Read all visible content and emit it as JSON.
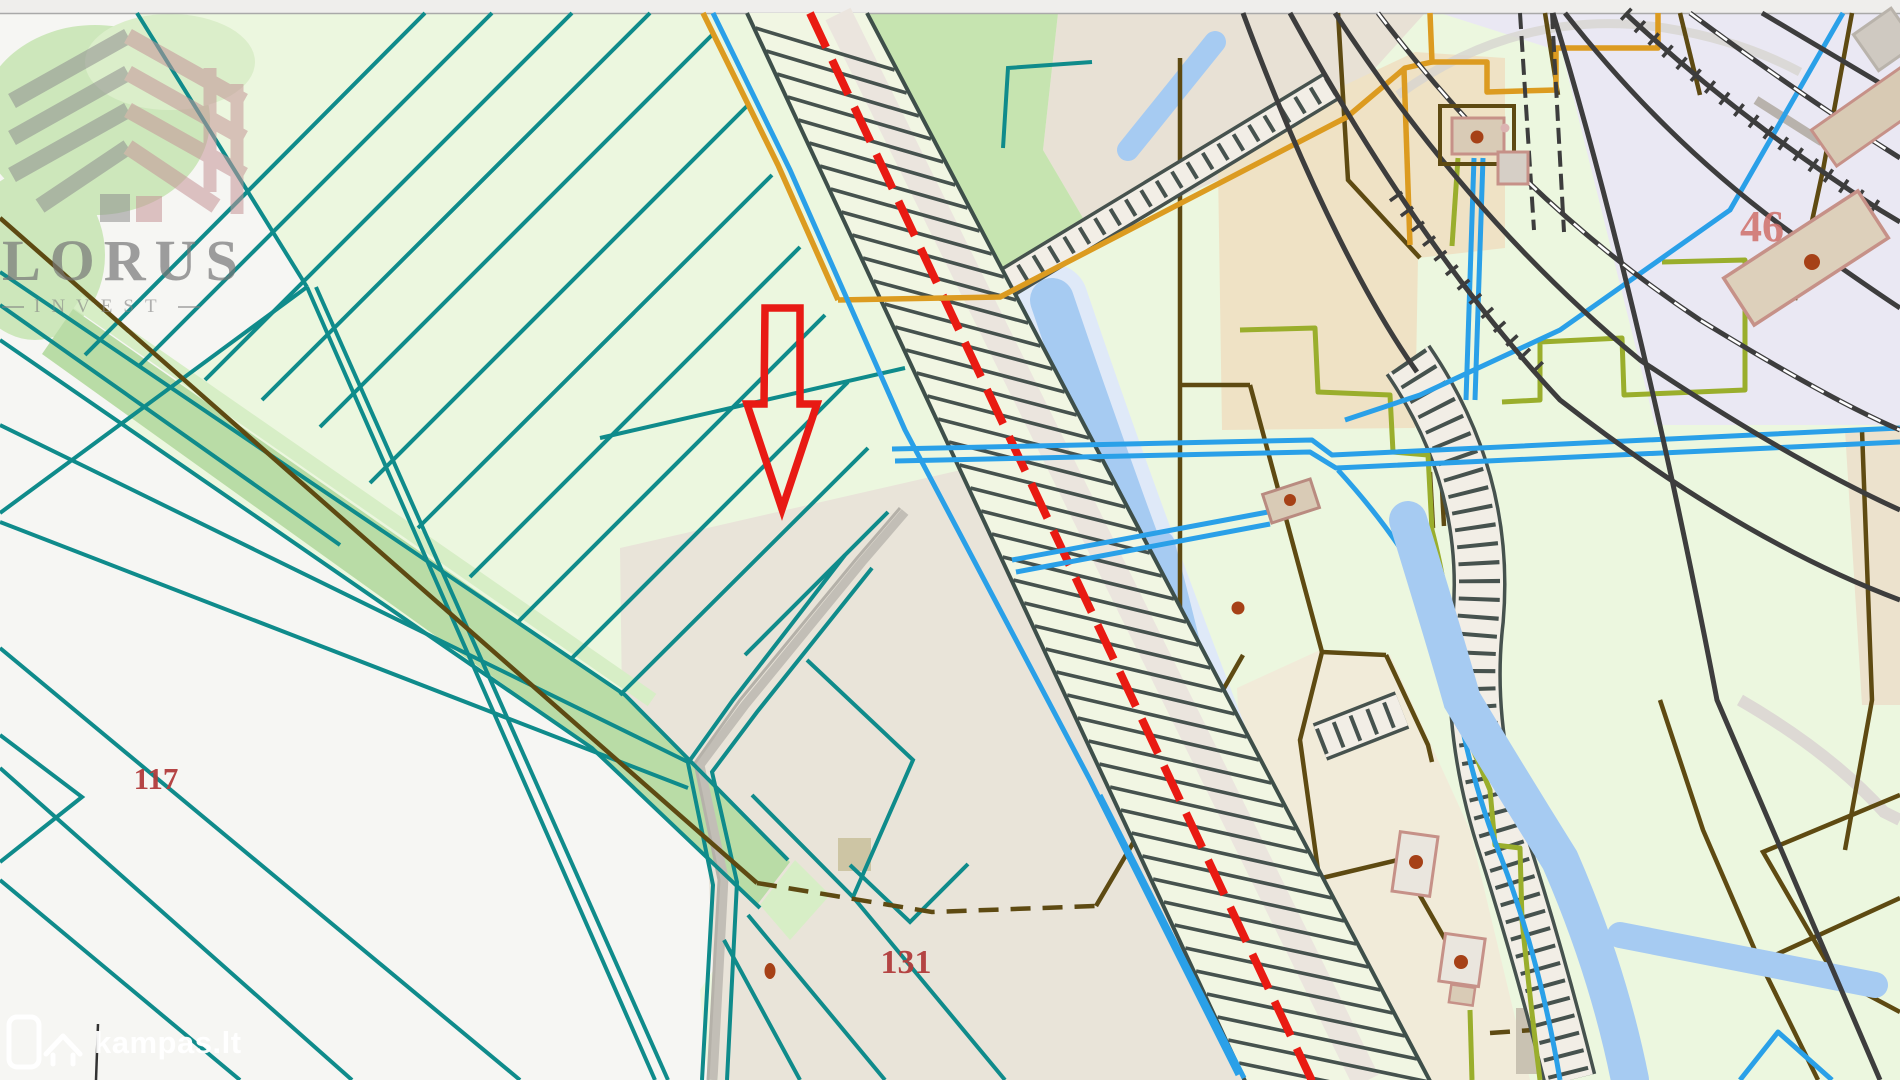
{
  "map": {
    "attribution": {
      "brand": "kampas.lt"
    },
    "watermark": {
      "title": "LORUS",
      "subtitle": "INVEST"
    },
    "labels": {
      "p117": {
        "text": "117",
        "x": 156,
        "y": 789,
        "size": 31,
        "color": "#b23c3c",
        "opacity": 0.95
      },
      "p131": {
        "text": "131",
        "x": 906,
        "y": 973,
        "size": 34,
        "color": "#b23c3c",
        "opacity": 0.95
      },
      "p46": {
        "text": "46",
        "x": 1762,
        "y": 241,
        "size": 44,
        "color": "#d0706a",
        "opacity": 0.85
      }
    },
    "annotation": {
      "arrow_color": "#e81a14"
    },
    "colors": {
      "base_green": "#ecf7df",
      "white_area": "#f6f6f3",
      "blob_green": "#cde7bb",
      "blob_green_light": "#dbeeca",
      "beige_gray": "#e9e4d9",
      "beige_top": "#e8e1d5",
      "tan_warm": "#efe2c5",
      "lavender": "#eae8f3",
      "beige_right": "#f1ebd9",
      "tan_edge": "#ece2cd",
      "green_mid": "#c6e4b0",
      "khaki": "#cdc5a4",
      "ribbon": "#b9dca6",
      "ribbon_light": "#d7eec6",
      "teal": "#0f8b8b",
      "azure": "#2aa0e8",
      "river": "#a6cbf2",
      "river_pale": "#dfe9f8",
      "orange": "#dc9b20",
      "olive": "#9aae2c",
      "brown": "#5e4a12",
      "rust": "#a64117",
      "charcoal": "#3d3d3d",
      "hatch_dark": "#46524e",
      "corridor_edge": "#3e4f4a",
      "corridor_fill": "#f1f6e3",
      "corridor_band": "#ebe5de",
      "red_line": "#e91a12",
      "road_gray": "#c2beb6",
      "ghost_gray": "#d7d4cf",
      "pink_stroke": "#c69188"
    }
  }
}
